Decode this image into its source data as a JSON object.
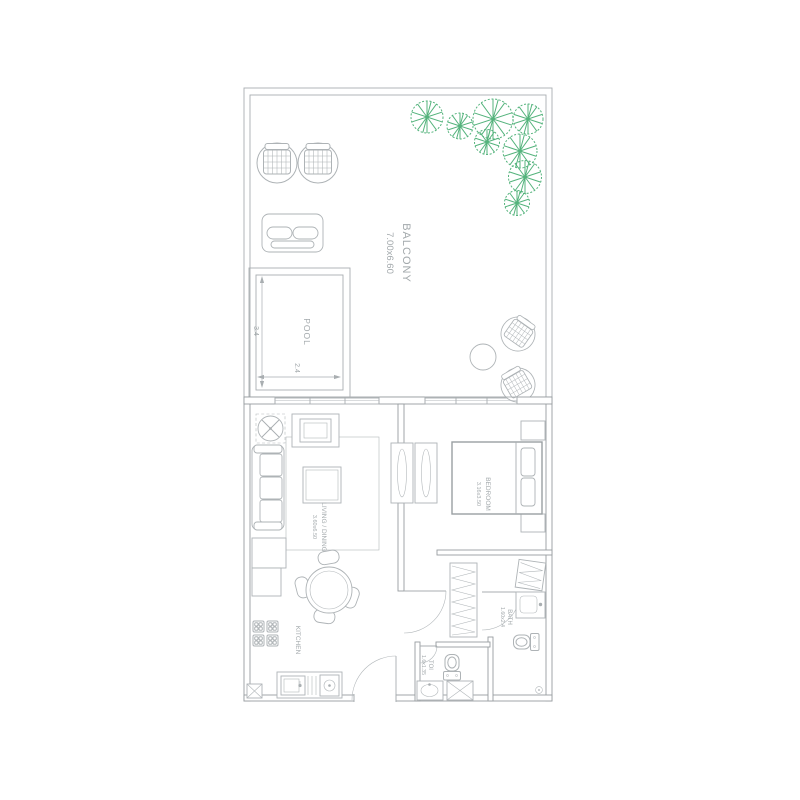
{
  "colors": {
    "line": "#a9aeb1",
    "wall": "#979da0",
    "text": "#a3a9ac",
    "tree_green": "#54b37c"
  },
  "rooms": {
    "balcony": {
      "label": "BALCONY",
      "size": "7.00x6.60"
    },
    "pool": {
      "label": "POOL",
      "depth": "3.4",
      "width": "2.4"
    },
    "living_dining": {
      "label": "LIVING / DINING",
      "size": "3.60x6.50"
    },
    "bedroom": {
      "label": "BEDROOM",
      "size": "3.16x3.50"
    },
    "kitchen": {
      "label": "KITCHEN"
    },
    "bath": {
      "label": "BATH",
      "size": "1.60x2.4"
    },
    "toilet": {
      "label": "TOI",
      "size": "1.6x1.35"
    }
  }
}
